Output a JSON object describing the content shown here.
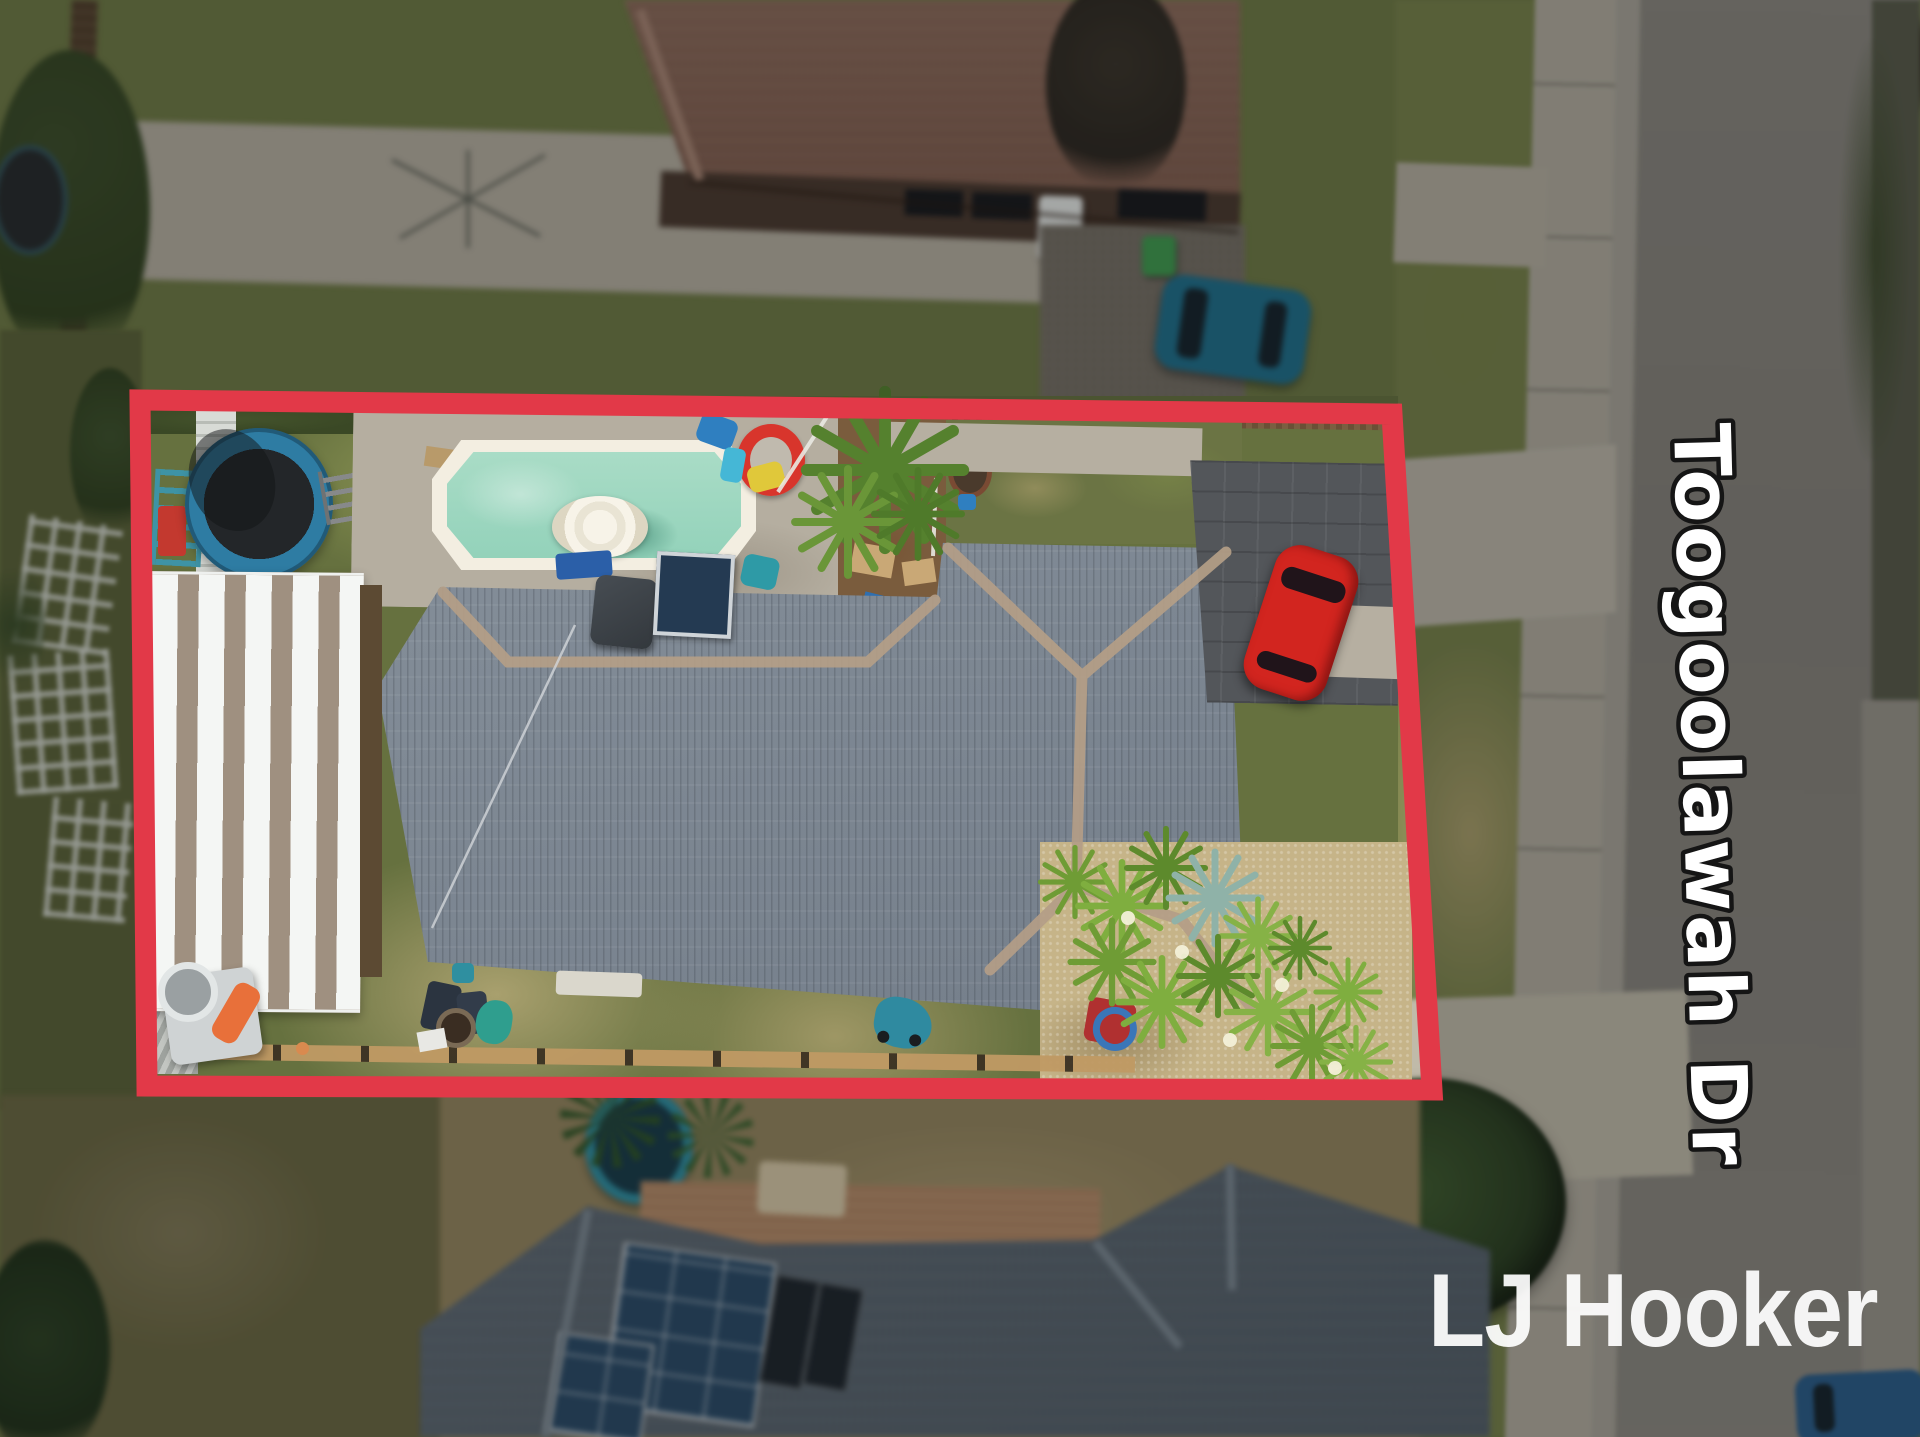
{
  "photo": {
    "type": "aerial-drone-real-estate-photo",
    "street_label": "Toogoolawah Dr",
    "watermark_brand": "LJ Hooker",
    "colors": {
      "boundary_red": "#e23948",
      "lawn_green": "#6f7a45",
      "pool_water": "#a5dac4",
      "subject_roof_gray": "#7c8793",
      "neighbor_roof_brown": "#8d695a",
      "bottom_roof_slate": "#5f6a74",
      "road_gray": "#87837c",
      "red_car": "#d2251f",
      "blue_car": "#1f6f8c"
    }
  }
}
